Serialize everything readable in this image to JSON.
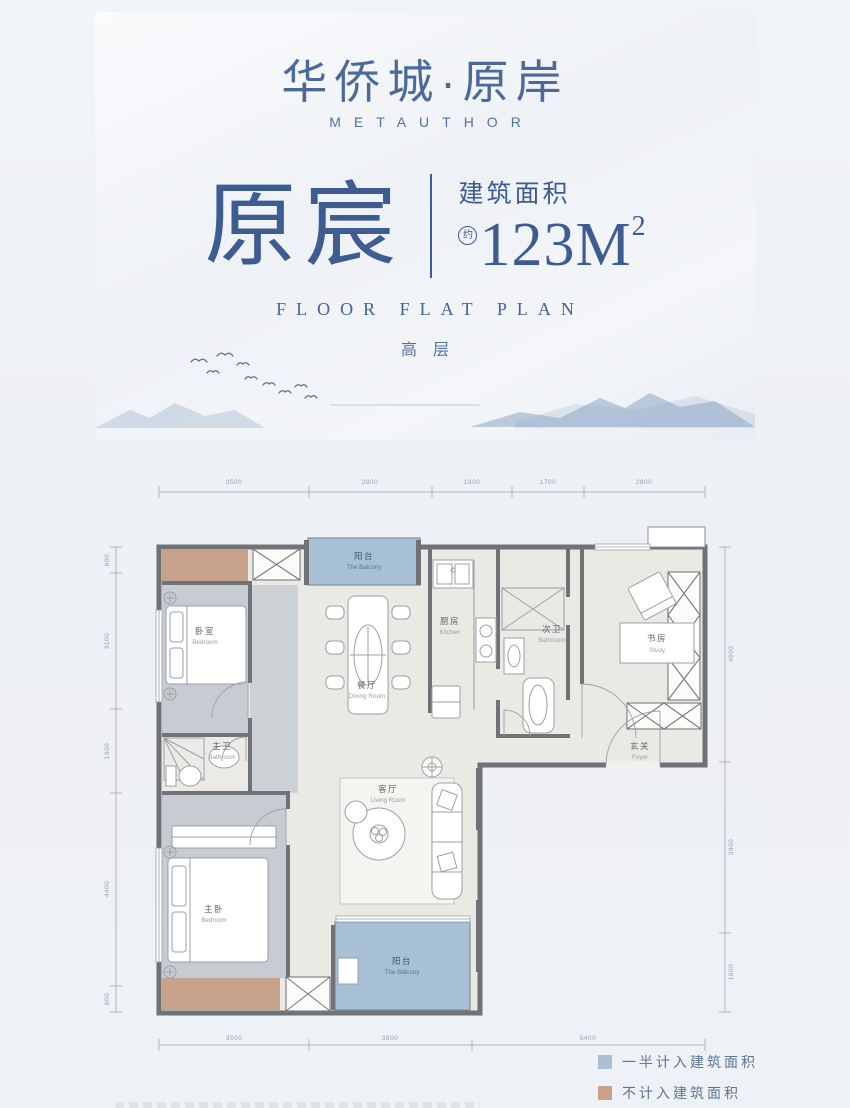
{
  "header": {
    "logo_cn": "华侨城·原岸",
    "brand_en": "METAUTHOR",
    "plan_name": "原宸",
    "area_label": "建筑面积",
    "area_approx": "约",
    "area_value": "123M",
    "area_sup": "2",
    "subtitle_en": "FLOOR FLAT PLAN",
    "floor_type": "高层"
  },
  "floorplan": {
    "dimensions": {
      "top": [
        "3500",
        "2800",
        "1900",
        "1700",
        "2800"
      ],
      "bottom": [
        "3500",
        "3800",
        "5400"
      ],
      "left": [
        "600",
        "3100",
        "1900",
        "4400",
        "600"
      ],
      "right": [
        "4900",
        "3900",
        "1800"
      ]
    },
    "rooms": {
      "balcony_top": {
        "cn": "阳台",
        "en": "The Balcony"
      },
      "bedroom1": {
        "cn": "卧室",
        "en": "Bedroom"
      },
      "master_bath": {
        "cn": "主卫",
        "en": "Bathroom"
      },
      "master_bedroom": {
        "cn": "主卧",
        "en": "Bedroom"
      },
      "dining": {
        "cn": "餐厅",
        "en": "Dining Room"
      },
      "kitchen": {
        "cn": "厨房",
        "en": "Kitchen"
      },
      "bath2": {
        "cn": "次卫",
        "en": "Bathroom"
      },
      "study": {
        "cn": "书房",
        "en": "Study"
      },
      "foyer": {
        "cn": "玄关",
        "en": "Foyer"
      },
      "living": {
        "cn": "客厅",
        "en": "Living Room"
      },
      "balcony_bottom": {
        "cn": "阳台",
        "en": "The Balcony"
      }
    },
    "legend": [
      {
        "label": "一半计入建筑面积",
        "color": "#a7c0d6"
      },
      {
        "label": "不计入建筑面积",
        "color": "#c8a18a"
      }
    ],
    "colors": {
      "wall": "#6f7377",
      "balcony_blue": "#a7c0d6",
      "excluded_tan": "#c8a18a",
      "floor_gray": "#c7ccd2",
      "floor_light": "#eae9e4",
      "title_blue": "#3d5c92"
    }
  }
}
